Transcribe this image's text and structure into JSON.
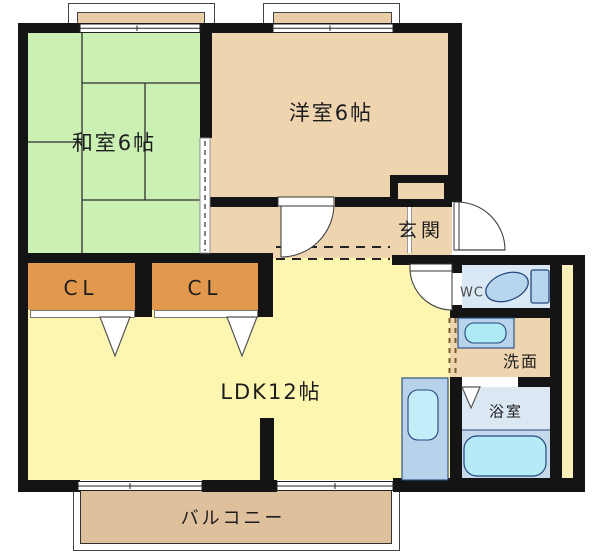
{
  "floorplan": {
    "type": "apartment-floor-plan",
    "rooms": {
      "washitsu": {
        "label": "和室6帖"
      },
      "yoshitsu": {
        "label": "洋室6帖"
      },
      "genkan": {
        "label": "玄関"
      },
      "closet_left": {
        "label": "CL"
      },
      "closet_right": {
        "label": "CL"
      },
      "ldk": {
        "label": "LDK12帖"
      },
      "wc": {
        "label": "WC"
      },
      "washroom": {
        "label": "洗面"
      },
      "bathroom": {
        "label": "浴室"
      },
      "balcony": {
        "label": "バルコニー"
      }
    },
    "fixtures": [
      "toilet",
      "wash-basin",
      "bathtub",
      "kitchen-sink"
    ],
    "colors": {
      "tatami_green": "#cbf0b4",
      "wood_tan": "#eed5b0",
      "ldk_yellow": "#fcf6b0",
      "closet_orange": "#e2984d",
      "wet_room_blue": "#dae8f5",
      "fixture_blue": "#b7d2ea",
      "sink_cyan": "#b5ebf6",
      "balcony_tan": "#dfc09c",
      "pipe_space_yellow": "#f8f0b8",
      "wall_black": "#141414"
    }
  }
}
